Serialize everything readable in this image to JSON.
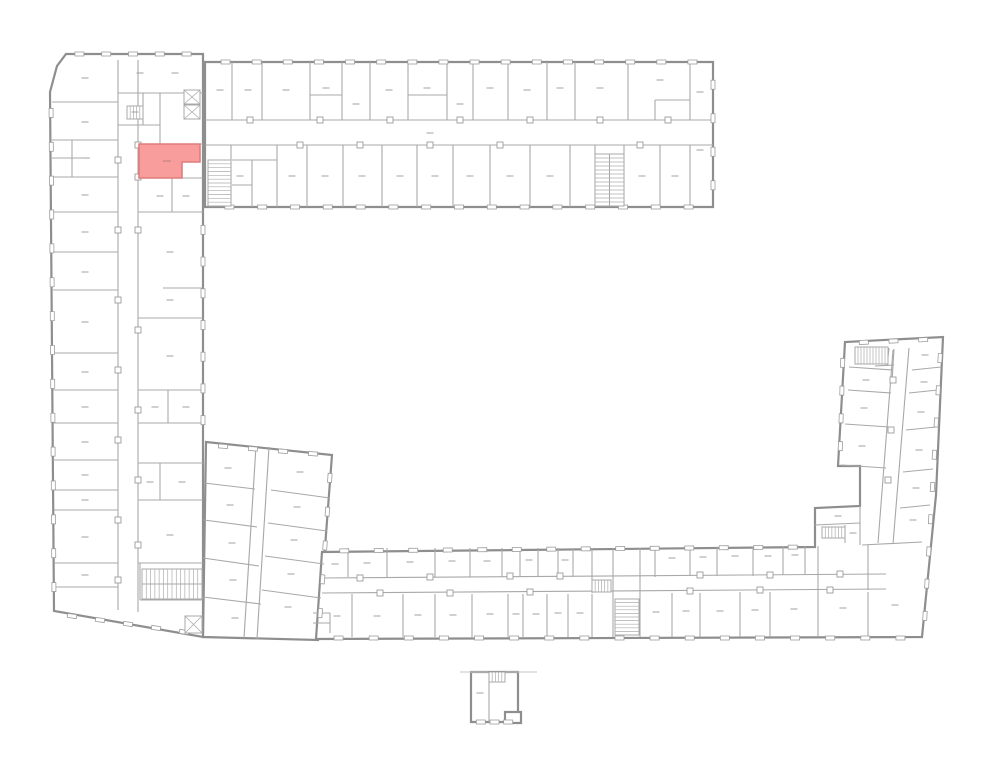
{
  "meta": {
    "canvas_w": 1000,
    "canvas_h": 777,
    "background": "#ffffff"
  },
  "style": {
    "outer_stroke": "#8e8e8e",
    "outer_width": 2.2,
    "inner_stroke": "#a8a8a8",
    "inner_width": 1.1,
    "light_stroke": "#c6c6c6",
    "light_width": 0.9,
    "window_stroke": "#9d9d9d",
    "window_fill": "#ffffff",
    "door_stroke": "#9d9d9d",
    "door_fill": "#ffffff",
    "hatch_stroke": "#adadad",
    "label_stroke": "#a0a0a0",
    "highlight_fill": "#f89c9c",
    "highlight_stroke": "#df7d7d"
  },
  "outlines": [
    {
      "name": "connector-wing",
      "points": [
        [
          206,
          442
        ],
        [
          332,
          455
        ],
        [
          318,
          640
        ],
        [
          203,
          637
        ]
      ]
    },
    {
      "name": "left-wing",
      "points": [
        [
          66,
          54
        ],
        [
          203,
          54
        ],
        [
          203,
          637
        ],
        [
          54,
          611
        ],
        [
          50,
          92
        ],
        [
          57,
          66
        ]
      ]
    },
    {
      "name": "top-wing",
      "points": [
        [
          205,
          62
        ],
        [
          713,
          62
        ],
        [
          713,
          207
        ],
        [
          205,
          207
        ]
      ]
    },
    {
      "name": "bottom-and-right-wing",
      "points": [
        [
          316,
          639
        ],
        [
          322,
          552
        ],
        [
          815,
          547
        ],
        [
          815,
          508
        ],
        [
          860,
          506
        ],
        [
          860,
          466
        ],
        [
          838,
          466
        ],
        [
          845,
          342
        ],
        [
          943,
          337
        ],
        [
          936,
          495
        ],
        [
          922,
          637
        ]
      ]
    },
    {
      "name": "detached-building",
      "points": [
        [
          471,
          672
        ],
        [
          518,
          672
        ],
        [
          518,
          722
        ],
        [
          471,
          722
        ]
      ]
    },
    {
      "name": "detached-annex",
      "points": [
        [
          505,
          712
        ],
        [
          521,
          712
        ],
        [
          521,
          723
        ],
        [
          505,
          723
        ]
      ]
    }
  ],
  "walls": [
    [
      205,
      120,
      713,
      120
    ],
    [
      205,
      145,
      713,
      145
    ],
    [
      232,
      62,
      232,
      120
    ],
    [
      262,
      62,
      262,
      120
    ],
    [
      310,
      62,
      310,
      120
    ],
    [
      342,
      62,
      342,
      120
    ],
    [
      370,
      62,
      370,
      120
    ],
    [
      408,
      62,
      408,
      120
    ],
    [
      447,
      62,
      447,
      120
    ],
    [
      473,
      62,
      473,
      120
    ],
    [
      508,
      62,
      508,
      120
    ],
    [
      547,
      62,
      547,
      120
    ],
    [
      575,
      62,
      575,
      120
    ],
    [
      628,
      62,
      628,
      120
    ],
    [
      690,
      62,
      690,
      120
    ],
    [
      310,
      95,
      342,
      95
    ],
    [
      408,
      95,
      447,
      95
    ],
    [
      655,
      100,
      690,
      100
    ],
    [
      655,
      100,
      655,
      120
    ],
    [
      277,
      145,
      277,
      207
    ],
    [
      307,
      145,
      307,
      207
    ],
    [
      343,
      145,
      343,
      207
    ],
    [
      382,
      145,
      382,
      207
    ],
    [
      417,
      145,
      417,
      207
    ],
    [
      453,
      145,
      453,
      207
    ],
    [
      490,
      145,
      490,
      207
    ],
    [
      530,
      145,
      530,
      207
    ],
    [
      570,
      145,
      570,
      207
    ],
    [
      660,
      145,
      660,
      207
    ],
    [
      690,
      145,
      690,
      207
    ],
    [
      595,
      145,
      595,
      207
    ],
    [
      624,
      145,
      624,
      207
    ],
    [
      231,
      145,
      231,
      207
    ],
    [
      252,
      160,
      252,
      207
    ],
    [
      232,
      160,
      277,
      160
    ],
    [
      232,
      185,
      252,
      185
    ],
    [
      118,
      60,
      118,
      610
    ],
    [
      138,
      60,
      138,
      612
    ],
    [
      52,
      102,
      118,
      102
    ],
    [
      52,
      140,
      118,
      140
    ],
    [
      52,
      177,
      118,
      177
    ],
    [
      53,
      212,
      118,
      212
    ],
    [
      53,
      252,
      118,
      252
    ],
    [
      53,
      290,
      118,
      290
    ],
    [
      53,
      353,
      118,
      353
    ],
    [
      53,
      390,
      118,
      390
    ],
    [
      53,
      423,
      118,
      423
    ],
    [
      53,
      460,
      118,
      460
    ],
    [
      54,
      490,
      118,
      490
    ],
    [
      54,
      510,
      118,
      510
    ],
    [
      54,
      563,
      118,
      563
    ],
    [
      54,
      587,
      118,
      587
    ],
    [
      72,
      140,
      72,
      177
    ],
    [
      52,
      158,
      90,
      158
    ],
    [
      138,
      144,
      203,
      144
    ],
    [
      138,
      178,
      203,
      178
    ],
    [
      138,
      212,
      203,
      212
    ],
    [
      138,
      318,
      203,
      318
    ],
    [
      138,
      390,
      203,
      390
    ],
    [
      138,
      423,
      203,
      423
    ],
    [
      138,
      463,
      203,
      463
    ],
    [
      138,
      500,
      203,
      500
    ],
    [
      138,
      563,
      203,
      563
    ],
    [
      140,
      600,
      203,
      600
    ],
    [
      140,
      563,
      140,
      600
    ],
    [
      163,
      288,
      203,
      288
    ],
    [
      172,
      178,
      172,
      212
    ],
    [
      168,
      390,
      168,
      423
    ],
    [
      160,
      463,
      160,
      500
    ],
    [
      118,
      93,
      203,
      93
    ],
    [
      118,
      125,
      160,
      125
    ],
    [
      160,
      93,
      160,
      144
    ],
    [
      143,
      93,
      143,
      125
    ],
    [
      256,
      446,
      244,
      638
    ],
    [
      269,
      447,
      257,
      639
    ],
    [
      204,
      483,
      255,
      489
    ],
    [
      204,
      520,
      257,
      527
    ],
    [
      203,
      558,
      259,
      566
    ],
    [
      203,
      597,
      261,
      604
    ],
    [
      271,
      490,
      330,
      498
    ],
    [
      268,
      523,
      327,
      531
    ],
    [
      265,
      556,
      324,
      564
    ],
    [
      262,
      590,
      321,
      598
    ],
    [
      322,
      578,
      886,
      574
    ],
    [
      322,
      593,
      886,
      589
    ],
    [
      348,
      548,
      348,
      577
    ],
    [
      387,
      548,
      387,
      577
    ],
    [
      435,
      548,
      435,
      577
    ],
    [
      470,
      548,
      470,
      577
    ],
    [
      502,
      548,
      502,
      577
    ],
    [
      520,
      548,
      520,
      577
    ],
    [
      538,
      548,
      538,
      577
    ],
    [
      558,
      548,
      558,
      577
    ],
    [
      573,
      548,
      573,
      577
    ],
    [
      592,
      548,
      592,
      593
    ],
    [
      655,
      548,
      655,
      577
    ],
    [
      690,
      547,
      690,
      576
    ],
    [
      717,
      547,
      717,
      576
    ],
    [
      753,
      547,
      753,
      576
    ],
    [
      783,
      546,
      783,
      575
    ],
    [
      805,
      546,
      805,
      575
    ],
    [
      818,
      546,
      818,
      592
    ],
    [
      613,
      548,
      613,
      637
    ],
    [
      640,
      548,
      640,
      637
    ],
    [
      352,
      594,
      352,
      637
    ],
    [
      403,
      594,
      403,
      637
    ],
    [
      435,
      594,
      435,
      637
    ],
    [
      472,
      594,
      472,
      637
    ],
    [
      508,
      594,
      508,
      637
    ],
    [
      523,
      594,
      523,
      637
    ],
    [
      547,
      594,
      547,
      637
    ],
    [
      568,
      594,
      568,
      637
    ],
    [
      592,
      594,
      592,
      637
    ],
    [
      672,
      593,
      672,
      637
    ],
    [
      700,
      593,
      700,
      637
    ],
    [
      740,
      592,
      740,
      637
    ],
    [
      770,
      592,
      770,
      637
    ],
    [
      818,
      592,
      818,
      637
    ],
    [
      868,
      592,
      868,
      637
    ],
    [
      862,
      545,
      922,
      542
    ],
    [
      868,
      545,
      868,
      590
    ],
    [
      330,
      613,
      330,
      633
    ],
    [
      313,
      613,
      330,
      613
    ],
    [
      313,
      623,
      330,
      623
    ],
    [
      893,
      350,
      878,
      543
    ],
    [
      909,
      348,
      893,
      544
    ],
    [
      849,
      367,
      893,
      370
    ],
    [
      848,
      390,
      891,
      393
    ],
    [
      845,
      424,
      889,
      427
    ],
    [
      841,
      465,
      886,
      468
    ],
    [
      912,
      370,
      941,
      367
    ],
    [
      909,
      393,
      938,
      390
    ],
    [
      906,
      430,
      936,
      427
    ],
    [
      903,
      472,
      933,
      469
    ],
    [
      900,
      508,
      930,
      505
    ],
    [
      889,
      348,
      887,
      366
    ],
    [
      875,
      366,
      894,
      365
    ],
    [
      894,
      349,
      892,
      382
    ],
    [
      815,
      525,
      860,
      523
    ],
    [
      845,
      525,
      845,
      543
    ],
    [
      860,
      506,
      860,
      545
    ],
    [
      489,
      672,
      489,
      722
    ]
  ],
  "light_walls": [
    [
      460,
      672,
      537,
      672
    ]
  ],
  "window_runs": [
    [
      66,
      54,
      200,
      54,
      5
    ],
    [
      51,
      96,
      54,
      604,
      15
    ],
    [
      58,
      614,
      198,
      634,
      5
    ],
    [
      210,
      62,
      708,
      62,
      16
    ],
    [
      713,
      68,
      713,
      202,
      4
    ],
    [
      213,
      207,
      705,
      207,
      15
    ],
    [
      203,
      214,
      203,
      436,
      7
    ],
    [
      208,
      445,
      328,
      455,
      4
    ],
    [
      331,
      461,
      319,
      630,
      5
    ],
    [
      327,
      551,
      810,
      547,
      14
    ],
    [
      321,
      638,
      918,
      638,
      17
    ],
    [
      941,
      342,
      924,
      632,
      9
    ],
    [
      843,
      349,
      840,
      460,
      4
    ],
    [
      849,
      343,
      938,
      339,
      3
    ],
    [
      474,
      722,
      515,
      722,
      3
    ]
  ],
  "doors": [
    [
      250,
      120
    ],
    [
      320,
      120
    ],
    [
      390,
      120
    ],
    [
      460,
      120
    ],
    [
      530,
      120
    ],
    [
      600,
      120
    ],
    [
      668,
      120
    ],
    [
      300,
      145
    ],
    [
      360,
      145
    ],
    [
      430,
      145
    ],
    [
      500,
      145
    ],
    [
      640,
      145
    ],
    [
      118,
      160
    ],
    [
      118,
      230
    ],
    [
      118,
      300
    ],
    [
      118,
      370
    ],
    [
      118,
      440
    ],
    [
      118,
      520
    ],
    [
      118,
      580
    ],
    [
      138,
      145
    ],
    [
      138,
      177
    ],
    [
      138,
      230
    ],
    [
      138,
      330
    ],
    [
      138,
      410
    ],
    [
      138,
      480
    ],
    [
      138,
      545
    ],
    [
      360,
      578
    ],
    [
      430,
      577
    ],
    [
      510,
      576
    ],
    [
      560,
      576
    ],
    [
      700,
      575
    ],
    [
      770,
      575
    ],
    [
      840,
      574
    ],
    [
      380,
      593
    ],
    [
      450,
      593
    ],
    [
      530,
      592
    ],
    [
      690,
      591
    ],
    [
      760,
      590
    ],
    [
      830,
      590
    ],
    [
      893,
      380
    ],
    [
      891,
      430
    ],
    [
      888,
      480
    ]
  ],
  "stairs": [
    {
      "x": 208,
      "y": 160,
      "w": 23,
      "h": 46,
      "dir": "h",
      "steps": 12
    },
    {
      "x": 595,
      "y": 154,
      "w": 29,
      "h": 52,
      "dir": "h",
      "steps": 13,
      "divider": "v"
    },
    {
      "x": 142,
      "y": 569,
      "w": 60,
      "h": 30,
      "dir": "v",
      "steps": 14,
      "divider": "h"
    },
    {
      "x": 615,
      "y": 599,
      "w": 24,
      "h": 36,
      "dir": "h",
      "steps": 10
    },
    {
      "x": 855,
      "y": 347,
      "w": 33,
      "h": 17,
      "dir": "v",
      "steps": 11
    },
    {
      "x": 822,
      "y": 527,
      "w": 23,
      "h": 11,
      "dir": "v",
      "steps": 7
    },
    {
      "x": 592,
      "y": 580,
      "w": 19,
      "h": 12,
      "dir": "v",
      "steps": 6
    },
    {
      "x": 489,
      "y": 672,
      "w": 16,
      "h": 10,
      "dir": "v",
      "steps": 5
    },
    {
      "x": 127,
      "y": 106,
      "w": 16,
      "h": 13,
      "dir": "v",
      "steps": 5
    }
  ],
  "elevators": [
    {
      "x": 184,
      "y": 90,
      "w": 16,
      "h": 14
    },
    {
      "x": 184,
      "y": 105,
      "w": 16,
      "h": 14
    },
    {
      "x": 185,
      "y": 616,
      "w": 17,
      "h": 17
    }
  ],
  "labels": [
    [
      220,
      90
    ],
    [
      248,
      90
    ],
    [
      286,
      90
    ],
    [
      326,
      88
    ],
    [
      356,
      104
    ],
    [
      389,
      90
    ],
    [
      427,
      88
    ],
    [
      460,
      104
    ],
    [
      490,
      88
    ],
    [
      527,
      90
    ],
    [
      560,
      88
    ],
    [
      600,
      88
    ],
    [
      660,
      80
    ],
    [
      700,
      92
    ],
    [
      240,
      176
    ],
    [
      292,
      176
    ],
    [
      325,
      176
    ],
    [
      362,
      176
    ],
    [
      400,
      176
    ],
    [
      435,
      176
    ],
    [
      470,
      176
    ],
    [
      510,
      176
    ],
    [
      550,
      176
    ],
    [
      642,
      176
    ],
    [
      675,
      176
    ],
    [
      700,
      150
    ],
    [
      430,
      133
    ],
    [
      85,
      78
    ],
    [
      85,
      122
    ],
    [
      85,
      158
    ],
    [
      85,
      195
    ],
    [
      85,
      232
    ],
    [
      85,
      272
    ],
    [
      85,
      322
    ],
    [
      85,
      372
    ],
    [
      85,
      407
    ],
    [
      85,
      442
    ],
    [
      85,
      475
    ],
    [
      85,
      500
    ],
    [
      85,
      537
    ],
    [
      85,
      575
    ],
    [
      160,
      196
    ],
    [
      186,
      196
    ],
    [
      170,
      252
    ],
    [
      170,
      300
    ],
    [
      170,
      356
    ],
    [
      155,
      407
    ],
    [
      186,
      407
    ],
    [
      150,
      482
    ],
    [
      182,
      482
    ],
    [
      170,
      535
    ],
    [
      140,
      73
    ],
    [
      175,
      73
    ],
    [
      135,
      112
    ],
    [
      228,
      468
    ],
    [
      230,
      505
    ],
    [
      232,
      543
    ],
    [
      233,
      580
    ],
    [
      235,
      618
    ],
    [
      300,
      472
    ],
    [
      297,
      507
    ],
    [
      294,
      540
    ],
    [
      291,
      574
    ],
    [
      288,
      607
    ],
    [
      335,
      564
    ],
    [
      367,
      563
    ],
    [
      410,
      562
    ],
    [
      452,
      561
    ],
    [
      487,
      561
    ],
    [
      529,
      560
    ],
    [
      565,
      560
    ],
    [
      672,
      558
    ],
    [
      703,
      557
    ],
    [
      735,
      556
    ],
    [
      768,
      556
    ],
    [
      795,
      555
    ],
    [
      337,
      616
    ],
    [
      377,
      616
    ],
    [
      418,
      615
    ],
    [
      453,
      615
    ],
    [
      490,
      614
    ],
    [
      516,
      614
    ],
    [
      536,
      614
    ],
    [
      558,
      613
    ],
    [
      580,
      613
    ],
    [
      656,
      612
    ],
    [
      686,
      611
    ],
    [
      720,
      611
    ],
    [
      755,
      610
    ],
    [
      794,
      609
    ],
    [
      843,
      608
    ],
    [
      895,
      605
    ],
    [
      866,
      380
    ],
    [
      864,
      408
    ],
    [
      862,
      446
    ],
    [
      925,
      355
    ],
    [
      924,
      382
    ],
    [
      921,
      412
    ],
    [
      919,
      450
    ],
    [
      916,
      488
    ],
    [
      913,
      520
    ],
    [
      838,
      516
    ],
    [
      853,
      533
    ],
    [
      480,
      693
    ]
  ],
  "highlight": {
    "points": [
      [
        139,
        144
      ],
      [
        200,
        144
      ],
      [
        200,
        162
      ],
      [
        182,
        162
      ],
      [
        182,
        178
      ],
      [
        139,
        178
      ]
    ],
    "label": [
      167,
      161
    ]
  }
}
